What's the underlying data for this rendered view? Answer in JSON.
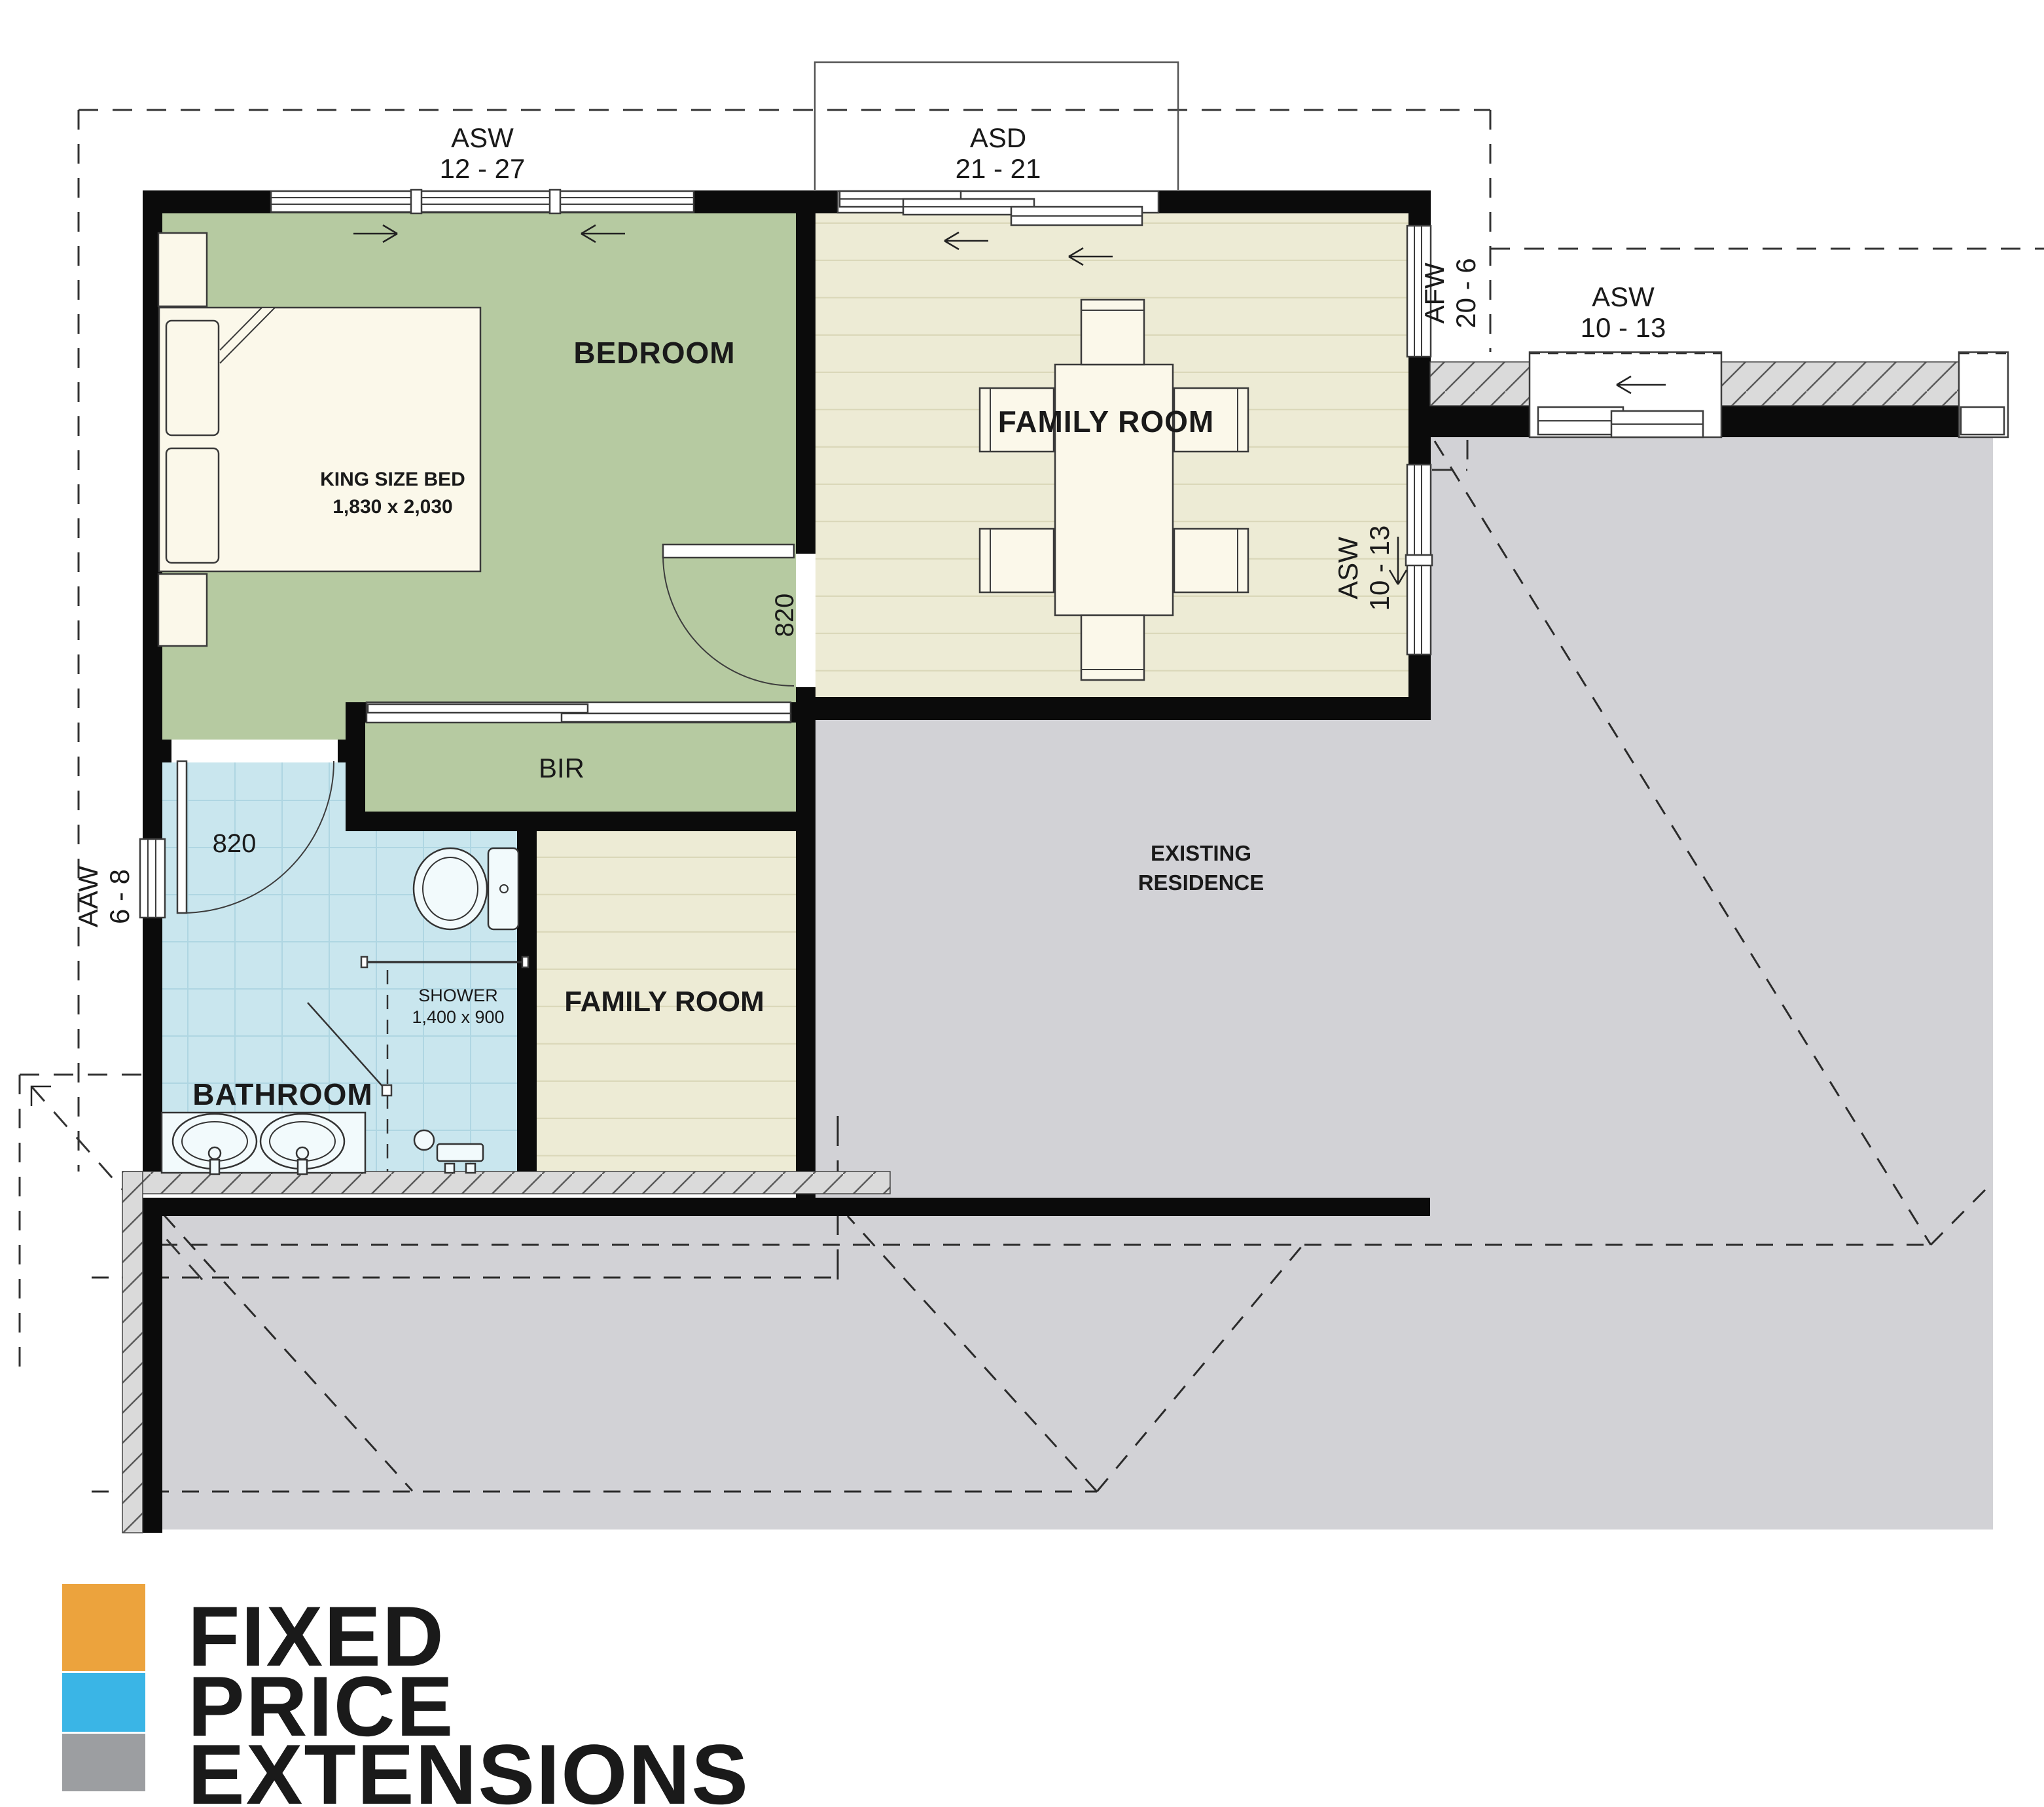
{
  "plan": {
    "windows": {
      "bedroom_top": {
        "code": "ASW",
        "size": "12 - 27"
      },
      "family_top_door": {
        "code": "ASD",
        "size": "21 - 21"
      },
      "family_right_fixed": {
        "code": "AFW",
        "size": "20 - 6"
      },
      "existing_top": {
        "code": "ASW",
        "size": "10 - 13"
      },
      "family_right_slide": {
        "code": "ASW",
        "size": "10 - 13"
      },
      "bathroom_left": {
        "code": "AAW",
        "size": "6 - 8"
      }
    },
    "doors": {
      "bedroom_door": "820",
      "bathroom_door": "820"
    },
    "rooms": {
      "bedroom": "BEDROOM",
      "bir": "BIR",
      "family_upper": "FAMILY ROOM",
      "family_lower": "FAMILY ROOM",
      "bathroom": "BATHROOM",
      "existing_line1": "EXISTING",
      "existing_line2": "RESIDENCE"
    },
    "fixtures": {
      "bed_line1": "KING SIZE BED",
      "bed_line2": "1,830 x 2,030",
      "shower_line1": "SHOWER",
      "shower_line2": "1,400 x 900"
    },
    "colors": {
      "bedroom_green": "#B6CAA1",
      "family_beige": "#EDEBD5",
      "bathroom_blue": "#C9E6EE",
      "existing_gray": "#D2D2D6"
    }
  },
  "logo": {
    "line1": "FIXED",
    "line2": "PRICE",
    "line3": "EXTENSIONS",
    "orange": "#ECA33D",
    "blue": "#3AB5E6",
    "gray": "#9C9EA1",
    "text_gray": "#8C8F93"
  }
}
